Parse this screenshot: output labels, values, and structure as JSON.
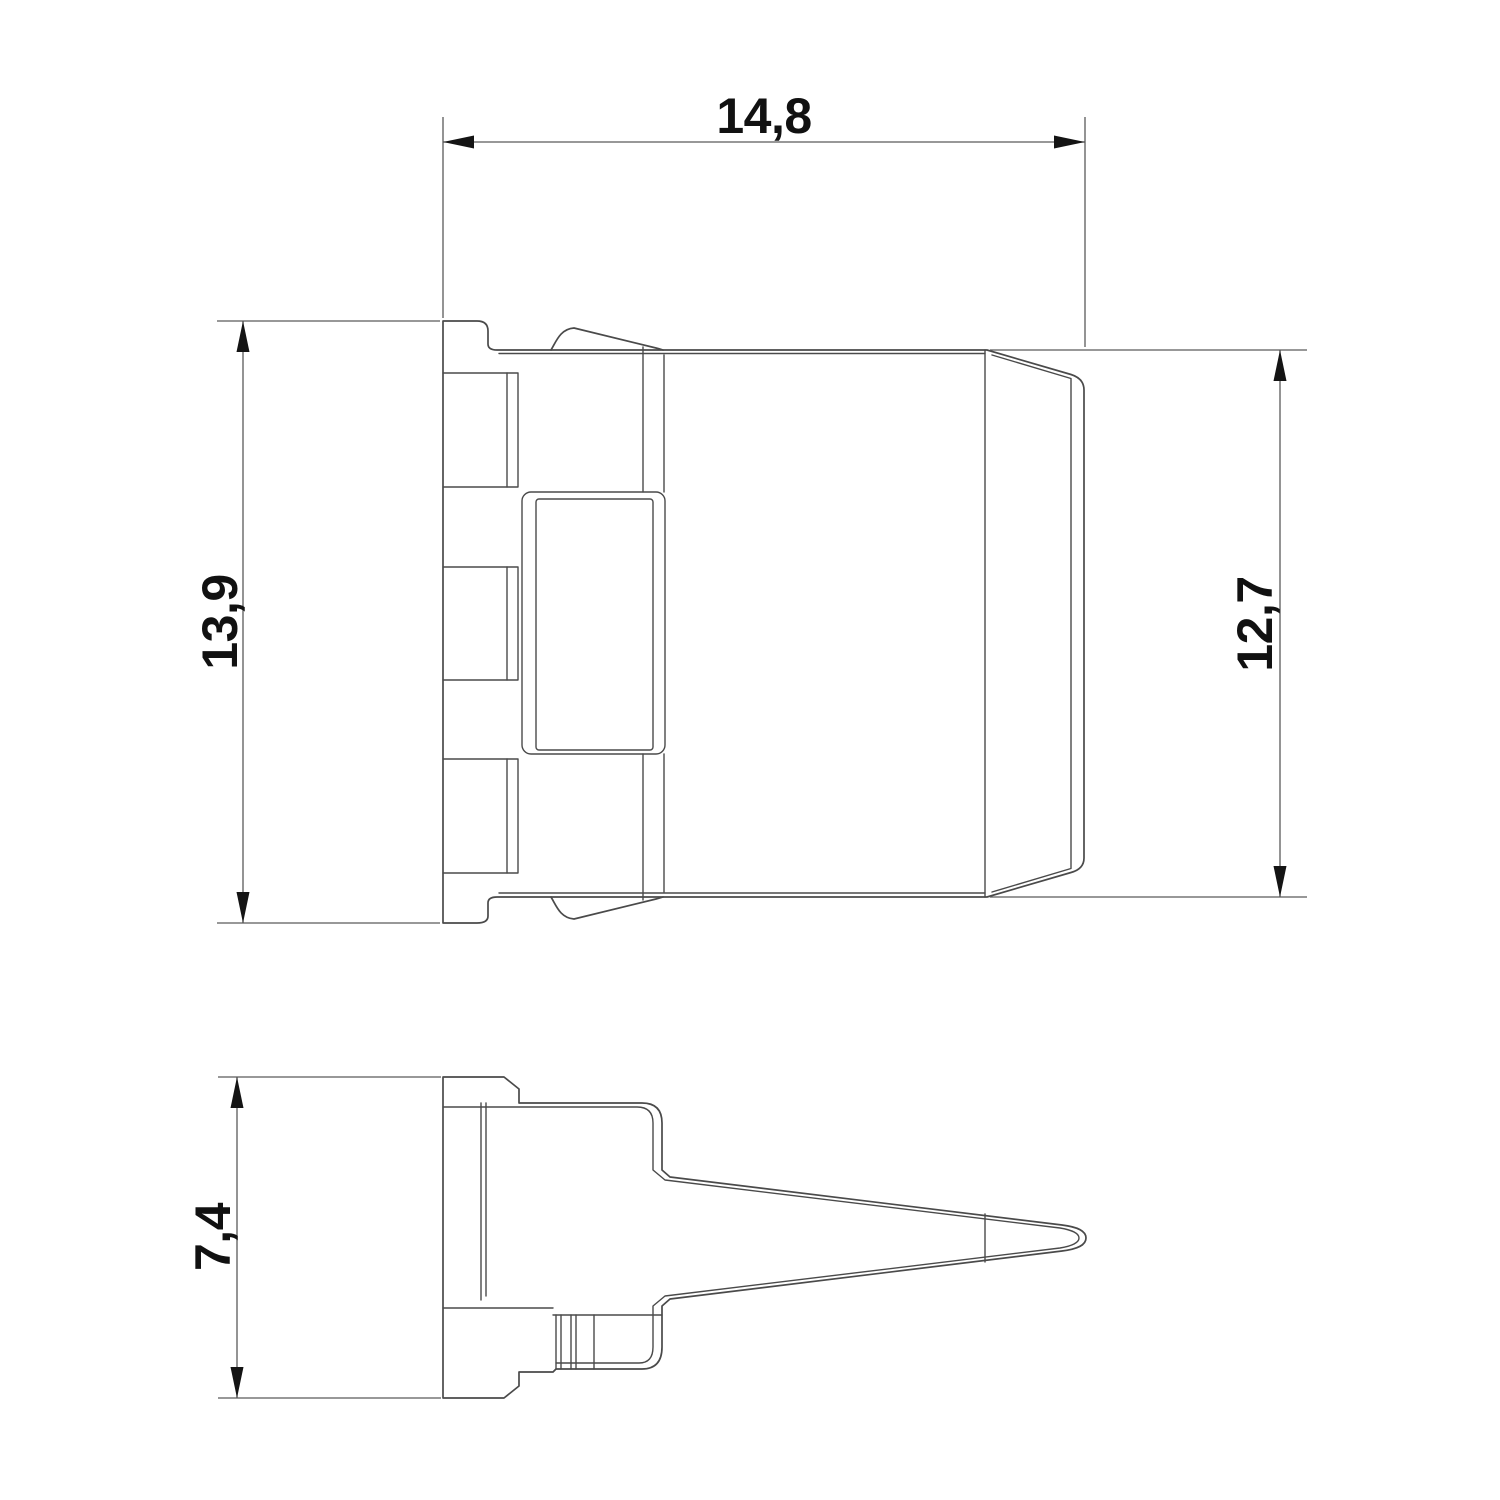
{
  "drawing": {
    "background_color": "#ffffff",
    "line_color": "#4a4a4a",
    "dimension_line_color": "#5a5a5a",
    "text_color": "#111111",
    "arrow_color": "#141414",
    "dimensions": {
      "overall_width_top": {
        "value": "14,8"
      },
      "overall_height_left": {
        "value": "13,9"
      },
      "front_height_right": {
        "value": "12,7"
      },
      "depth_bottom_left": {
        "value": "7,4"
      }
    }
  }
}
